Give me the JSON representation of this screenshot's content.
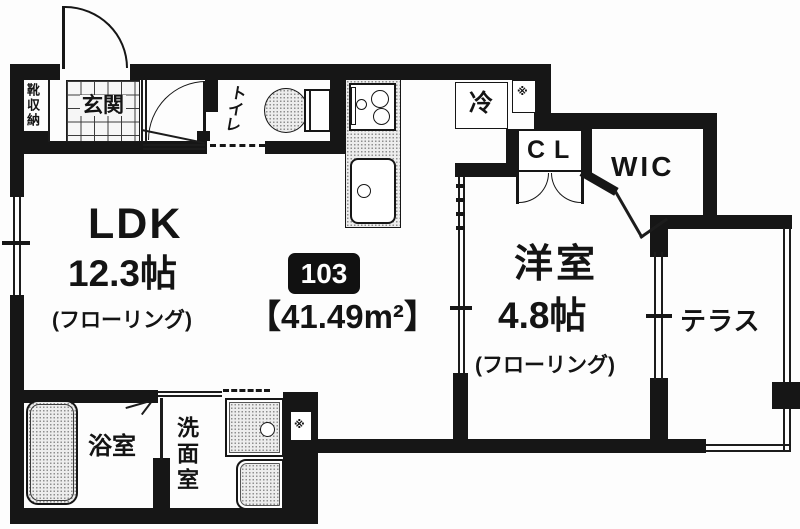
{
  "plan": {
    "unit_badge": "103",
    "area_label": "【41.49m²】",
    "ldk": {
      "name": "LDK",
      "size": "12.3帖",
      "floor": "(フローリング)"
    },
    "bedroom": {
      "name": "洋室",
      "size": "4.8帖",
      "floor": "(フローリング)"
    },
    "terrace": "テラス",
    "wic": "WIC",
    "closet": "CL",
    "fridge": "冷",
    "entrance": "玄関",
    "toilet": "トイレ",
    "bath": "浴室",
    "washroom": "洗面室",
    "shoe_storage": "靴収納",
    "ps_mark_top": "※",
    "ps_mark_bottom": "※"
  },
  "colors": {
    "wall": "#161616",
    "badge_bg": "#111111",
    "paper": "#fdfdfd"
  }
}
